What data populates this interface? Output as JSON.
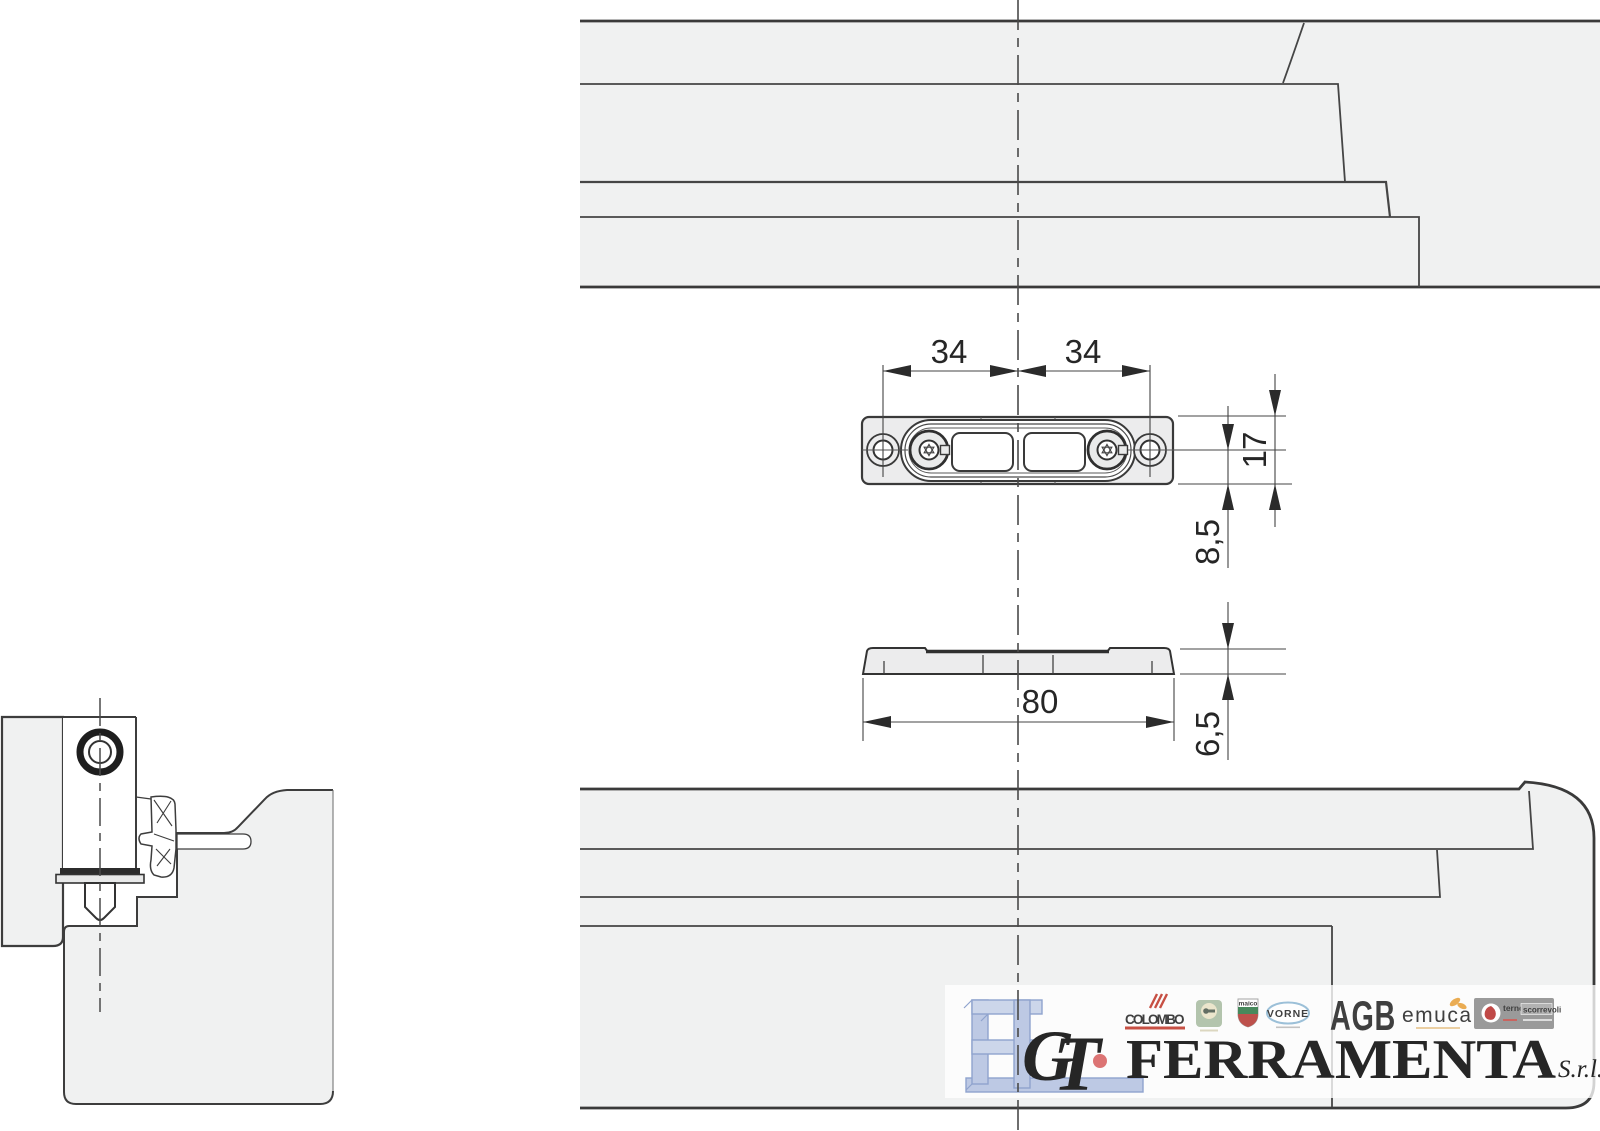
{
  "drawing": {
    "views": {
      "top_profile": "frame profile section top",
      "plan_view": "striker plate plan view",
      "side_view": "striker plate side view",
      "bottom_profile": "frame profile section bottom",
      "corner_section": "sash and frame cross section with locking cam"
    },
    "dimensions": {
      "center_to_left_hole_mm": "34",
      "center_to_right_hole_mm": "34",
      "plate_height_mm": "17",
      "hole_axis_to_edge_mm": "8,5",
      "plate_length_mm": "80",
      "plate_thickness_mm": "6,5"
    }
  },
  "watermark": {
    "script_g": "G",
    "script_t": "T",
    "company": "FERRAMENTA",
    "suffix": "S.r.l.",
    "logos": {
      "colombo": "COLOMBO",
      "maico": "maico",
      "vorne": "VORNE",
      "agb": "AGB",
      "emuca": "emuca",
      "terno_1": "terno",
      "terno_2": "scorrevoli"
    }
  },
  "colors": {
    "profile_fill": "#f0f1f1",
    "plate_fill": "#ececed",
    "line": "#3c3c3c",
    "watermark_red": "#cf5252",
    "watermark_blue": "#8ba2cf",
    "background": "#ffffff"
  }
}
